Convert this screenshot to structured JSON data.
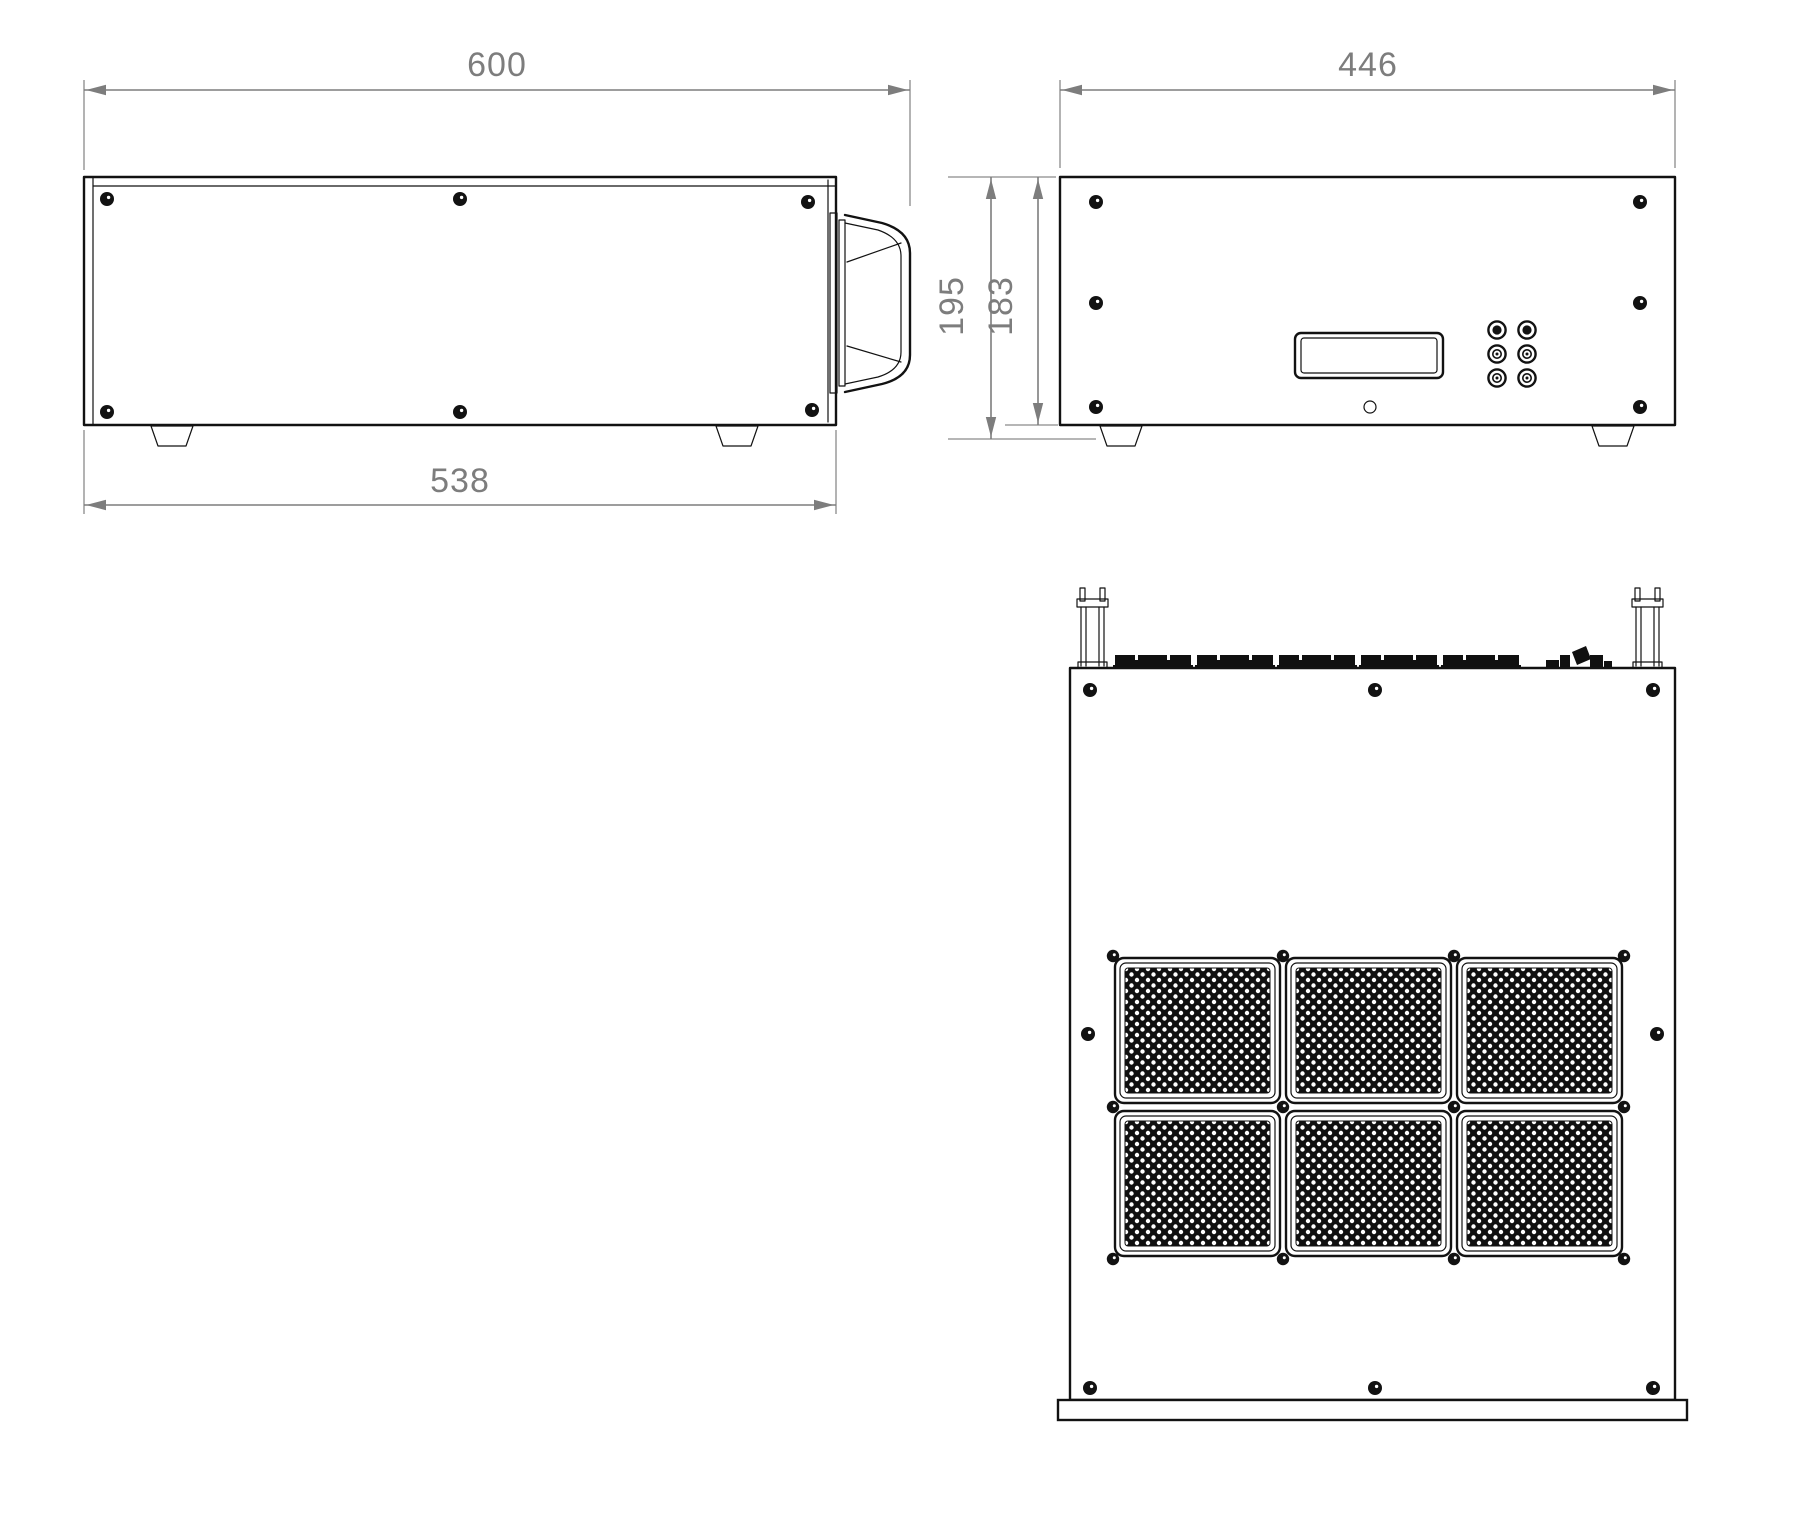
{
  "drawing": {
    "title": "rack-enclosure-three-view-drawing",
    "views": {
      "side_view": "side-view",
      "front_view": "front-view",
      "bottom_view": "bottom-view"
    },
    "dimensions": {
      "depth_total": "600",
      "depth_body": "538",
      "width_front": "446",
      "height_total": "195",
      "height_body": "183"
    },
    "colors": {
      "line": "#121212",
      "dimension": "#7d7d7d",
      "background": "#ffffff",
      "perforation_fill": "#101010"
    }
  }
}
